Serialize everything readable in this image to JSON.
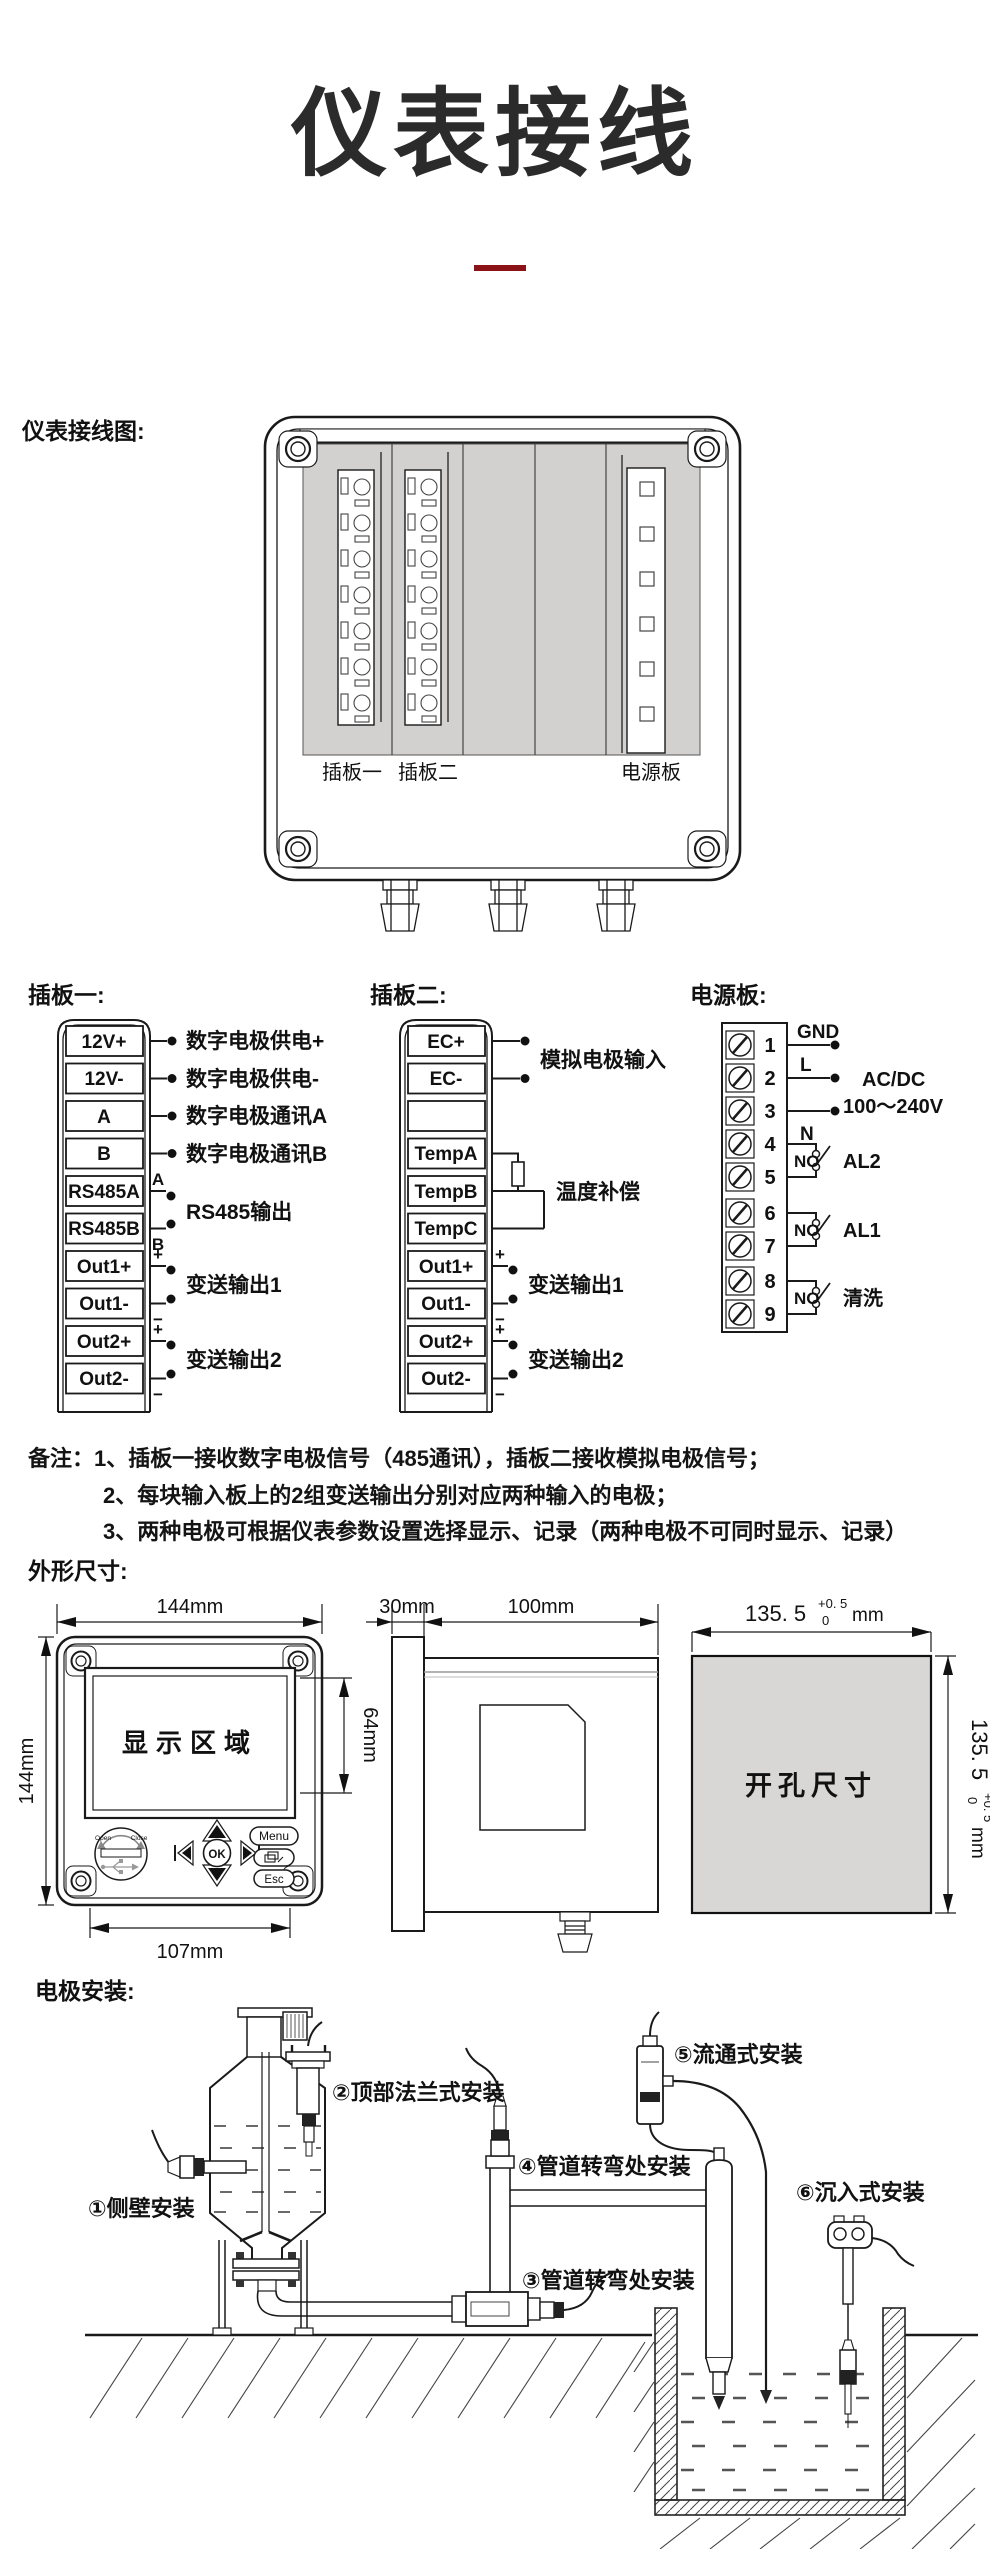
{
  "page": {
    "title": "仪表接线",
    "divider_color": "#8B1216"
  },
  "wiring": {
    "section_label": "仪表接线图:",
    "slot1_label": "插板一",
    "slot2_label": "插板二",
    "power_label": "电源板"
  },
  "board1": {
    "header": "插板一:",
    "terminals": [
      "12V+",
      "12V-",
      "A",
      "B",
      "RS485A",
      "RS485B",
      "Out1+",
      "Out1-",
      "Out2+",
      "Out2-"
    ],
    "wire_marks": {
      "a": "A",
      "b": "B",
      "p1": "+",
      "m1": "−",
      "p2": "+",
      "m2": "−"
    },
    "labels": {
      "l1": "数字电极供电+",
      "l2": "数字电极供电-",
      "l3": "数字电极通讯A",
      "l4": "数字电极通讯B",
      "l5": "RS485输出",
      "l6": "变送输出1",
      "l7": "变送输出2"
    }
  },
  "board2": {
    "header": "插板二:",
    "terminals": [
      "EC+",
      "EC-",
      "",
      "TempA",
      "TempB",
      "TempC",
      "Out1+",
      "Out1-",
      "Out2+",
      "Out2-"
    ],
    "wire_marks": {
      "p1": "+",
      "m1": "−",
      "p2": "+",
      "m2": "−"
    },
    "labels": {
      "l1": "模拟电极输入",
      "l2": "温度补偿",
      "l3": "变送输出1",
      "l4": "变送输出2"
    }
  },
  "power": {
    "header": "电源板:",
    "numbers": [
      "1",
      "2",
      "3",
      "4",
      "5",
      "6",
      "7",
      "8",
      "9"
    ],
    "gnd": "GND",
    "l": "L",
    "n": "N",
    "supply1": "AC/DC",
    "supply2": "100～240V",
    "relays": [
      {
        "no": "NO",
        "name": "AL2"
      },
      {
        "no": "NO",
        "name": "AL1"
      },
      {
        "no": "NO",
        "name": "清洗"
      }
    ]
  },
  "notes": {
    "line1": "备注：1、插板一接收数字电极信号（485通讯），插板二接收模拟电极信号；",
    "line2": "2、每块输入板上的2组变送输出分别对应两种输入的电极；",
    "line3": "3、两种电极可根据仪表参数设置选择显示、记录（两种电极不可同时显示、记录）"
  },
  "dimensions": {
    "header": "外形尺寸:",
    "front_width": "144mm",
    "front_height": "144mm",
    "display_label": "显示区域",
    "display_height": "64mm",
    "bottom_width": "107mm",
    "keys": {
      "ok": "OK",
      "menu": "Menu",
      "esc": "Esc"
    },
    "usb": {
      "open": "Open",
      "close": "Close"
    },
    "side_bezel": "30mm",
    "side_depth": "100mm",
    "cutout_label": "开孔尺寸",
    "cutout_w": {
      "main": "135. 5",
      "tol_up": "+0. 5",
      "tol_dn": "0",
      "unit": "mm"
    },
    "cutout_h": {
      "main": "135. 5",
      "tol_up": "+0. 5",
      "tol_dn": "0",
      "unit": "mm"
    }
  },
  "install": {
    "header": "电极安装:",
    "m1": "①侧壁安装",
    "m2": "②顶部法兰式安装",
    "m3": "③管道转弯处安装",
    "m4": "④管道转弯处安装",
    "m5": "⑤流通式安装",
    "m6": "⑥沉入式安装"
  }
}
